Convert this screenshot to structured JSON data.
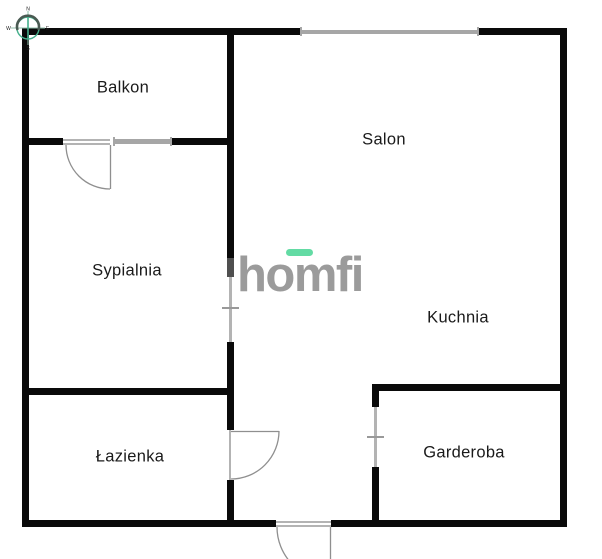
{
  "rooms": [
    {
      "label": "Balkon"
    },
    {
      "label": "Salon"
    },
    {
      "label": "Sypialnia"
    },
    {
      "label": "Kuchnia"
    },
    {
      "label": "Łazienka"
    },
    {
      "label": "Garderoba"
    }
  ],
  "logo": {
    "text": "homfi"
  },
  "compass": {
    "north": "N",
    "east": "E",
    "south": "S",
    "west": "W"
  },
  "colors": {
    "wall": "#0a0a0a",
    "window_gray": "#a6a6a6",
    "door_gray": "#8f8f8f",
    "doorline_gray": "#b3b3b3",
    "pocket_gray": "#4f4f4f",
    "logo_gray": "#9b9b9b",
    "brand_green": "#63dba4",
    "compass_green": "#45b08c",
    "label_text": "#1a1a1a"
  }
}
